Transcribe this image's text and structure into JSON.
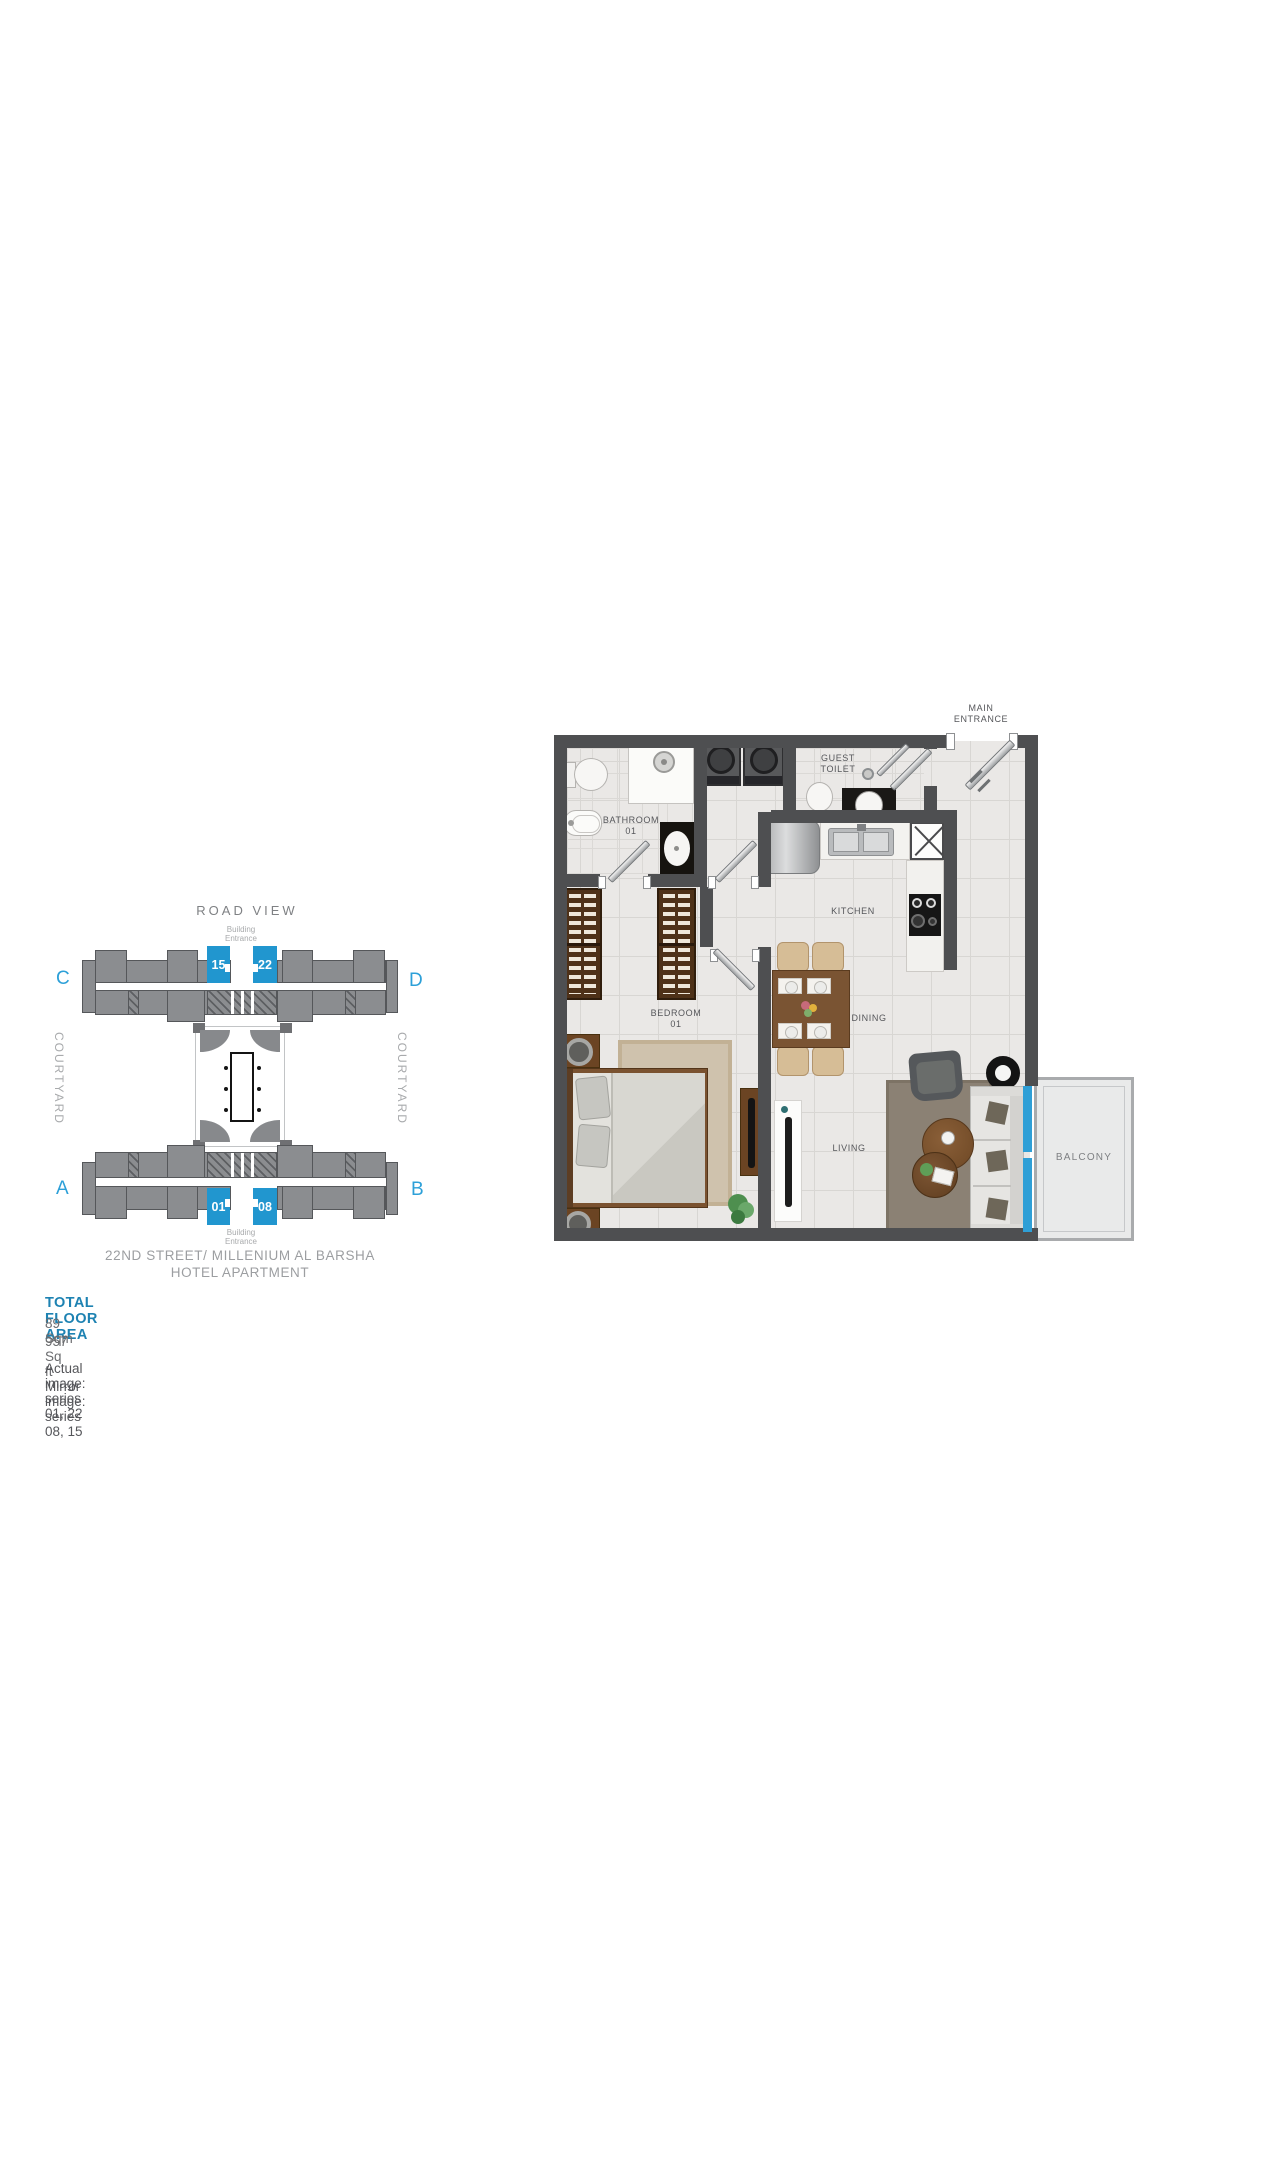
{
  "site": {
    "road_view": "ROAD VIEW",
    "entrance_top": {
      "l1": "Building",
      "l2": "Entrance"
    },
    "entrance_bottom": {
      "l1": "Building",
      "l2": "Entrance"
    },
    "corners": {
      "top_left": "C",
      "top_right": "D",
      "bottom_left": "A",
      "bottom_right": "B"
    },
    "top_units": [
      "15",
      "22"
    ],
    "bottom_units": [
      "01",
      "08"
    ],
    "courtyard_left": "COURTYARD",
    "courtyard_right": "COURTYARD",
    "street": {
      "l1": "22ND STREET/ MILLENIUM AL BARSHA",
      "l2": "HOTEL APARTMENT"
    }
  },
  "summary": {
    "title": "TOTAL FLOOR AREA",
    "sqm": "89 Sqm",
    "sqft": "957 Sq ft",
    "actual": "Actual image: series 01, 22",
    "mirror": "Mirror image: series 08, 15"
  },
  "plan": {
    "labels": {
      "main_entrance": {
        "l1": "MAIN",
        "l2": "ENTRANCE"
      },
      "bathroom": {
        "l1": "BATHROOM",
        "l2": "01"
      },
      "guest_toilet": {
        "l1": "GUEST",
        "l2": "TOILET"
      },
      "kitchen": "KITCHEN",
      "bedroom": {
        "l1": "BEDROOM",
        "l2": "01"
      },
      "dining": "DINING",
      "living": "LIVING",
      "balcony": "BALCONY"
    }
  },
  "colors": {
    "unit_blue": "#2196cf",
    "letter_blue": "#2da0d8",
    "balcony_door_blue": "#2f9fd6",
    "title_blue": "#1d82b2",
    "building_gray": "#8b8d90",
    "wall_dark": "#4e4f51"
  }
}
